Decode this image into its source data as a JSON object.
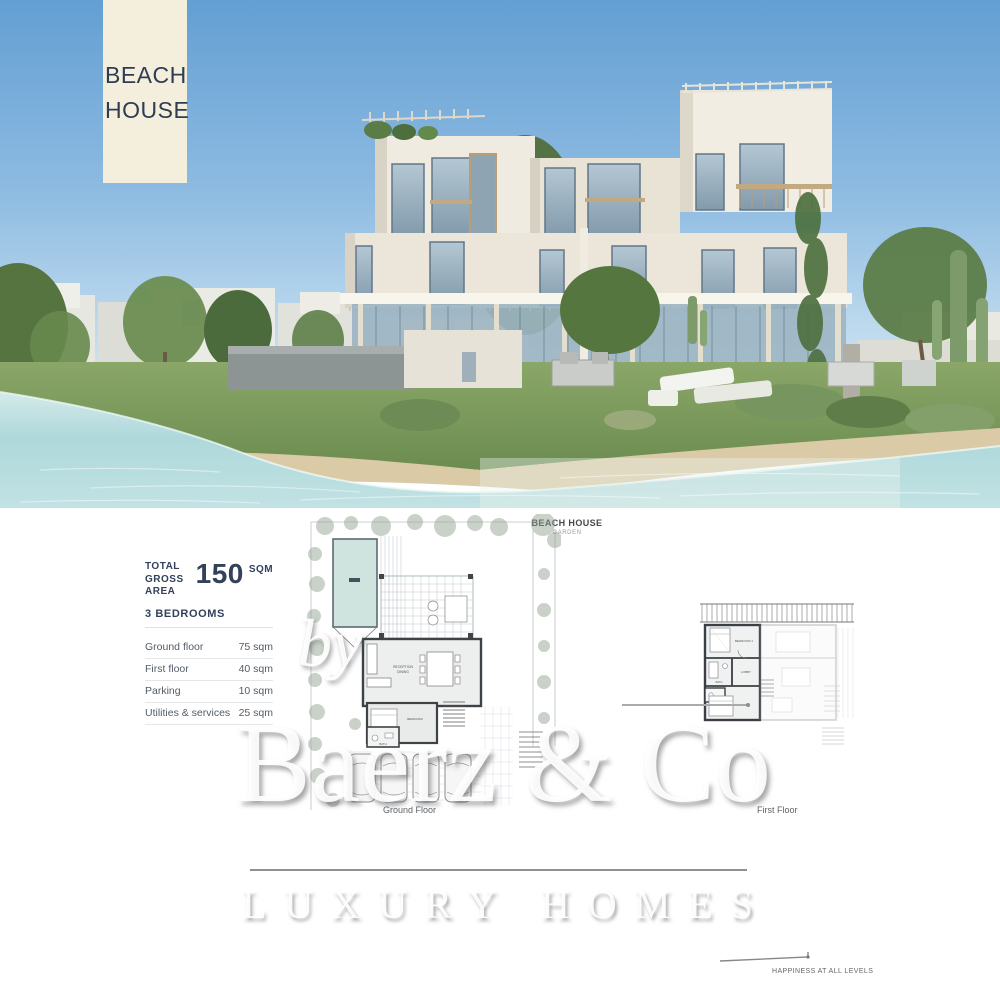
{
  "badge": {
    "line1": "BEACH",
    "line2": "HOUSE"
  },
  "specs": {
    "total_label_1": "TOTAL",
    "total_label_2": "GROSS AREA",
    "total_value": "150",
    "total_unit": "SQM",
    "bedrooms": "3 BEDROOMS",
    "rows": [
      {
        "label": "Ground floor",
        "value": "75 sqm"
      },
      {
        "label": "First floor",
        "value": "40 sqm"
      },
      {
        "label": "Parking",
        "value": "10 sqm"
      },
      {
        "label": "Utilities & services",
        "value": "25 sqm"
      }
    ]
  },
  "plans": {
    "header_title": "BEACH HOUSE",
    "header_subtitle": "GARDEN",
    "ground_floor_label": "Ground Floor",
    "first_floor_label": "First Floor",
    "ground_rooms": {
      "reception": "RECEPTION",
      "dining": "DINING",
      "bedroom": "BEDROOM",
      "bath": "BATH"
    },
    "first_rooms": {
      "bedroom1": "BEDROOM 1",
      "lobby": "LOBBY",
      "bath": "BATH"
    }
  },
  "watermark": {
    "by": "by",
    "brand": "Baerz & Co",
    "tagline": "LUXURY HOMES"
  },
  "footer_note": "HAPPINESS AT ALL LEVELS",
  "colors": {
    "badge_bg": "#f4eedd",
    "text_navy": "#2e3d52",
    "pool": "#cfe4de",
    "sky_top": "#639fd3",
    "water": "#aed8db",
    "building": "#efeade"
  }
}
